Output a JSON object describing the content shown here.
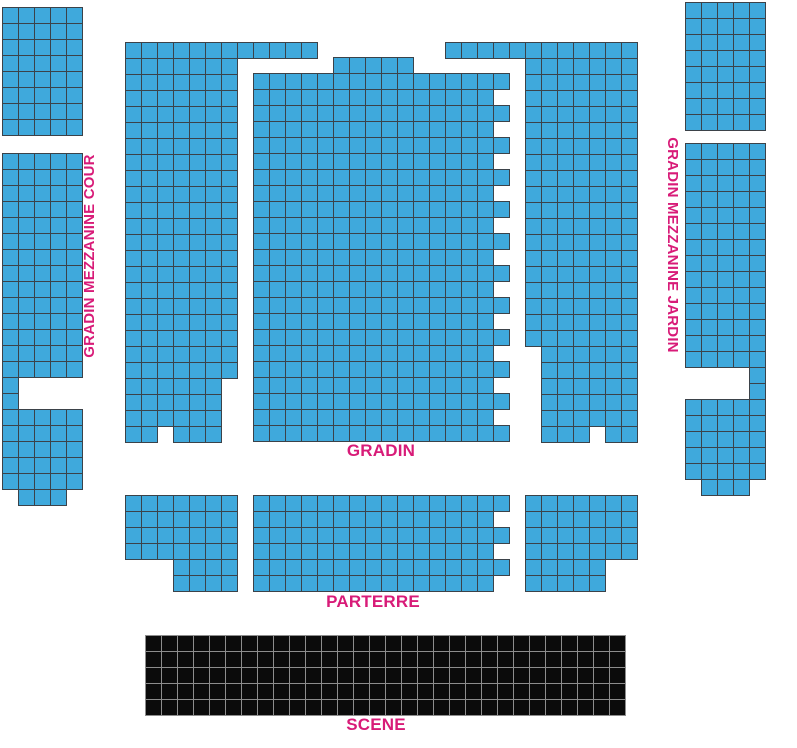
{
  "labels": {
    "left_mezzanine": "GRADIN MEZZANINE COUR",
    "right_mezzanine": "GRADIN MEZZANINE JARDIN",
    "gradin": "GRADIN",
    "parterre": "PARTERRE",
    "scene": "SCENE"
  },
  "colors": {
    "seat": "#3fa9dc",
    "seat_border": "#3b4249",
    "stage": "#0b0b0b",
    "stage_border": "#8d8d8d",
    "label": "#d81b78",
    "background": "#ffffff"
  },
  "cell": {
    "size": 16
  },
  "sections": [
    {
      "name": "mezzanine-cour-upper-block",
      "type": "seats",
      "rects": [
        [
          2,
          7,
          5,
          8
        ]
      ]
    },
    {
      "name": "mezzanine-cour-main-block",
      "type": "seats",
      "rects": [
        [
          2,
          153,
          5,
          14
        ],
        [
          2,
          377,
          1,
          2
        ],
        [
          2,
          409,
          5,
          5
        ],
        [
          18,
          489,
          3,
          1
        ]
      ]
    },
    {
      "name": "gradin-cour-block",
      "type": "seats",
      "rects": [
        [
          125,
          42,
          12,
          1
        ],
        [
          125,
          58,
          7,
          20
        ],
        [
          125,
          378,
          6,
          3
        ],
        [
          125,
          426,
          2,
          1
        ],
        [
          173,
          426,
          3,
          1
        ]
      ]
    },
    {
      "name": "gradin-center-block",
      "type": "seats",
      "rects": [
        [
          333,
          57,
          5,
          1
        ],
        [
          253,
          73,
          15,
          23
        ],
        [
          493,
          73,
          1,
          1
        ],
        [
          493,
          105,
          1,
          1
        ],
        [
          493,
          137,
          1,
          1
        ],
        [
          493,
          169,
          1,
          1
        ],
        [
          493,
          201,
          1,
          1
        ],
        [
          493,
          233,
          1,
          1
        ],
        [
          493,
          265,
          1,
          1
        ],
        [
          493,
          297,
          1,
          1
        ],
        [
          493,
          329,
          1,
          1
        ],
        [
          493,
          361,
          1,
          1
        ],
        [
          493,
          393,
          1,
          1
        ],
        [
          493,
          425,
          1,
          1
        ]
      ]
    },
    {
      "name": "gradin-jardin-block",
      "type": "seats",
      "rects": [
        [
          445,
          42,
          12,
          1
        ],
        [
          525,
          58,
          1,
          18
        ],
        [
          541,
          58,
          6,
          23
        ],
        [
          541,
          426,
          3,
          1
        ],
        [
          605,
          426,
          2,
          1
        ]
      ]
    },
    {
      "name": "mezzanine-jardin-upper-block",
      "type": "seats",
      "rects": [
        [
          685,
          2,
          5,
          8
        ]
      ]
    },
    {
      "name": "mezzanine-jardin-main-block",
      "type": "seats",
      "rects": [
        [
          685,
          143,
          5,
          14
        ],
        [
          749,
          367,
          1,
          2
        ],
        [
          685,
          399,
          5,
          5
        ],
        [
          701,
          479,
          3,
          1
        ]
      ]
    },
    {
      "name": "parterre-cour-block",
      "type": "seats",
      "rects": [
        [
          125,
          495,
          7,
          4
        ],
        [
          173,
          559,
          4,
          2
        ]
      ]
    },
    {
      "name": "parterre-center-block",
      "type": "seats",
      "rects": [
        [
          253,
          495,
          15,
          6
        ],
        [
          493,
          495,
          1,
          1
        ],
        [
          493,
          527,
          1,
          1
        ],
        [
          493,
          559,
          1,
          1
        ]
      ]
    },
    {
      "name": "parterre-jardin-block",
      "type": "seats",
      "rects": [
        [
          525,
          495,
          7,
          4
        ],
        [
          525,
          559,
          5,
          2
        ]
      ]
    },
    {
      "name": "stage-block",
      "type": "stage",
      "rects": [
        [
          145,
          635,
          30,
          5
        ]
      ]
    }
  ]
}
